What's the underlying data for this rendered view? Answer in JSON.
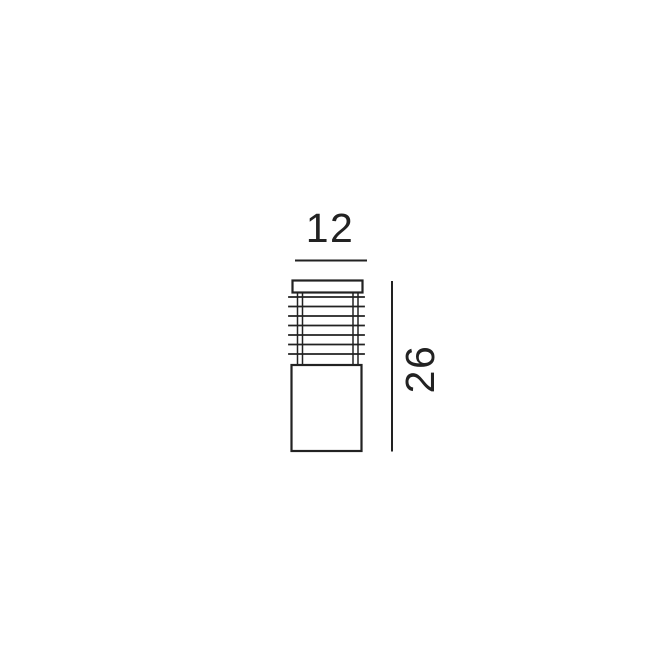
{
  "page": {
    "background_color": "#ffffff"
  },
  "diagram": {
    "subject": "bollard-outdoor-light-outline-drawing",
    "line_color": "#222222",
    "dimensions": {
      "width": {
        "label": "12"
      },
      "height": {
        "label": "26"
      }
    }
  }
}
